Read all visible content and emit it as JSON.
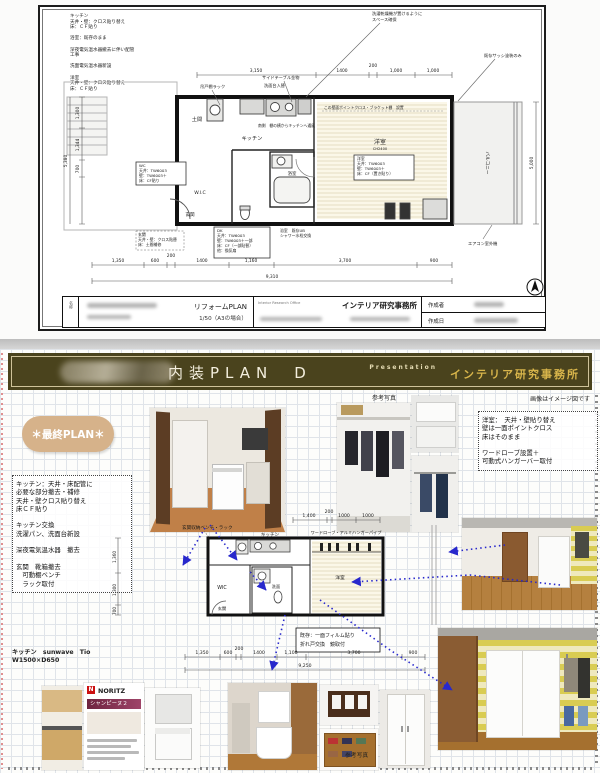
{
  "colors": {
    "band_olive": "#4a431d",
    "office_gold": "#d8b54b",
    "badge_tan": "#d6b28a",
    "arrow_blue": "#2828cc",
    "noritz_red": "#cc1111"
  },
  "top_drawing": {
    "notes": [
      "キッチン",
      "天井・壁：クロス貼り替え",
      "床：ＣＦ貼り",
      "",
      "浴室：既存のまま",
      "",
      "深夜電気温水器撤去に伴い配管",
      "工事",
      "",
      "洗面電気温水器新設",
      "",
      "洋室",
      "天井・壁：クロス貼り替え",
      "床：ＣＦ貼り"
    ],
    "callouts": {
      "rack": "吊戸棚ラック",
      "side_table": "サイドテーブル金物",
      "washstand": "洗面台入替",
      "laundry1": "洗濯乾燥機が置けるように",
      "laundry2": "スペース確保",
      "accent": "この壁面ポイントクロス・ブラケット棚　設置",
      "vent": "南側　棚の横からキッチンへ通風",
      "sash": "既存サッシ塗装のみ",
      "aircon": "エアコン室外機"
    },
    "rooms": {
      "doma": "土間",
      "kitchen": "キッチン",
      "bath": "浴室",
      "wic": "W.I.C",
      "genkan": "玄関",
      "yoshitsu": "洋室",
      "ch": "CH2400",
      "balcony": "バルコニー"
    },
    "spec_yoshitsu": [
      "洋室",
      "天井：TW6003",
      "壁：TW6003＋",
      "床：CF（置き貼り）"
    ],
    "spec_dk": [
      "DK",
      "天井：TW6003",
      "壁：TW6003＋一部",
      "床：CF（一部貼替）",
      "他：換気扇"
    ],
    "spec_wc": [
      "WC",
      "天井：TW6003",
      "壁：TW6003＋",
      "床：CF貼り"
    ],
    "spec_bath": [
      "浴室　既存UB",
      "シャワー水栓交換"
    ],
    "spec_genkan": [
      "玄関",
      "天井・壁：クロス貼替",
      "床：土間補修"
    ],
    "dims_top": [
      "3,150",
      "1400",
      "200",
      "1,000",
      "1,000"
    ],
    "dims_bottom": [
      "1,350",
      "600",
      "200",
      "1400",
      "1,160",
      "3,700",
      "900"
    ],
    "dim_total": "9,310",
    "dims_left": [
      "1,300",
      "1,344",
      "700"
    ],
    "dim_left_total": "5,380",
    "dim_right": "5,000",
    "title_block": {
      "name_label": "名称",
      "plan_title": "リフォームPLAN",
      "scale": "1/50（A3の場合）",
      "office_en": "Interior Research Office",
      "office": "インテリア研究事務所",
      "author_label": "作成者",
      "date_label": "作成日"
    }
  },
  "presentation": {
    "header": {
      "title": "内装PLAN　D",
      "tag": "Presentation",
      "office": "インテリア研究事務所"
    },
    "image_note": "画像はイメージ図です",
    "photo_note_top": "参考写真",
    "photo_note_bottom": "参考写真",
    "badge": "＊最終PLAN＊",
    "scope_left": [
      "キッチン：天井・床配管に",
      "必要な部分撤去・補修",
      "天井・壁クロス貼り替え",
      "床ＣＦ貼り",
      "",
      "キッチン交換",
      "洗濯パン、洗面台新設",
      "",
      "深夜電気温水器　撤去",
      "",
      "玄関　靴箱撤去",
      "　可動棚ベンチ",
      "　ラック取付"
    ],
    "kitchen_note": {
      "line1": "キッチン　sunwave　Tio",
      "line2": "W1500×D650"
    },
    "scope_right": [
      "洋室：　天井・壁貼り替え",
      "壁は一面ポイントクロス",
      "床はそのまま",
      "",
      "ワードローブ設置＋",
      "可動式ハンガーバー取付"
    ],
    "noritz": {
      "brand": "NORITZ",
      "product": "シャンピーヌ２"
    },
    "plan": {
      "labels": {
        "genkan_rack": "玄関収納ベンチ・ラック",
        "kitchen": "キッチン",
        "wardrobe": "ワードローブ・アルミハンガーパイプ",
        "senmen": "洗面",
        "wic": "WIC",
        "genkan": "玄関",
        "yoshitsu": "洋室"
      },
      "note_box": [
        "既存：一面フィルム貼り",
        "折れ戸交換　鏡取付"
      ],
      "dims_top": [
        "1,400",
        "200",
        "1000",
        "1000"
      ],
      "dims_bottom": [
        "1,350",
        "600",
        "200",
        "1400",
        "1,100",
        "3,700",
        "900"
      ],
      "dim_total": "9,250",
      "dims_left": [
        "1,360",
        "1,300",
        "700"
      ]
    }
  }
}
